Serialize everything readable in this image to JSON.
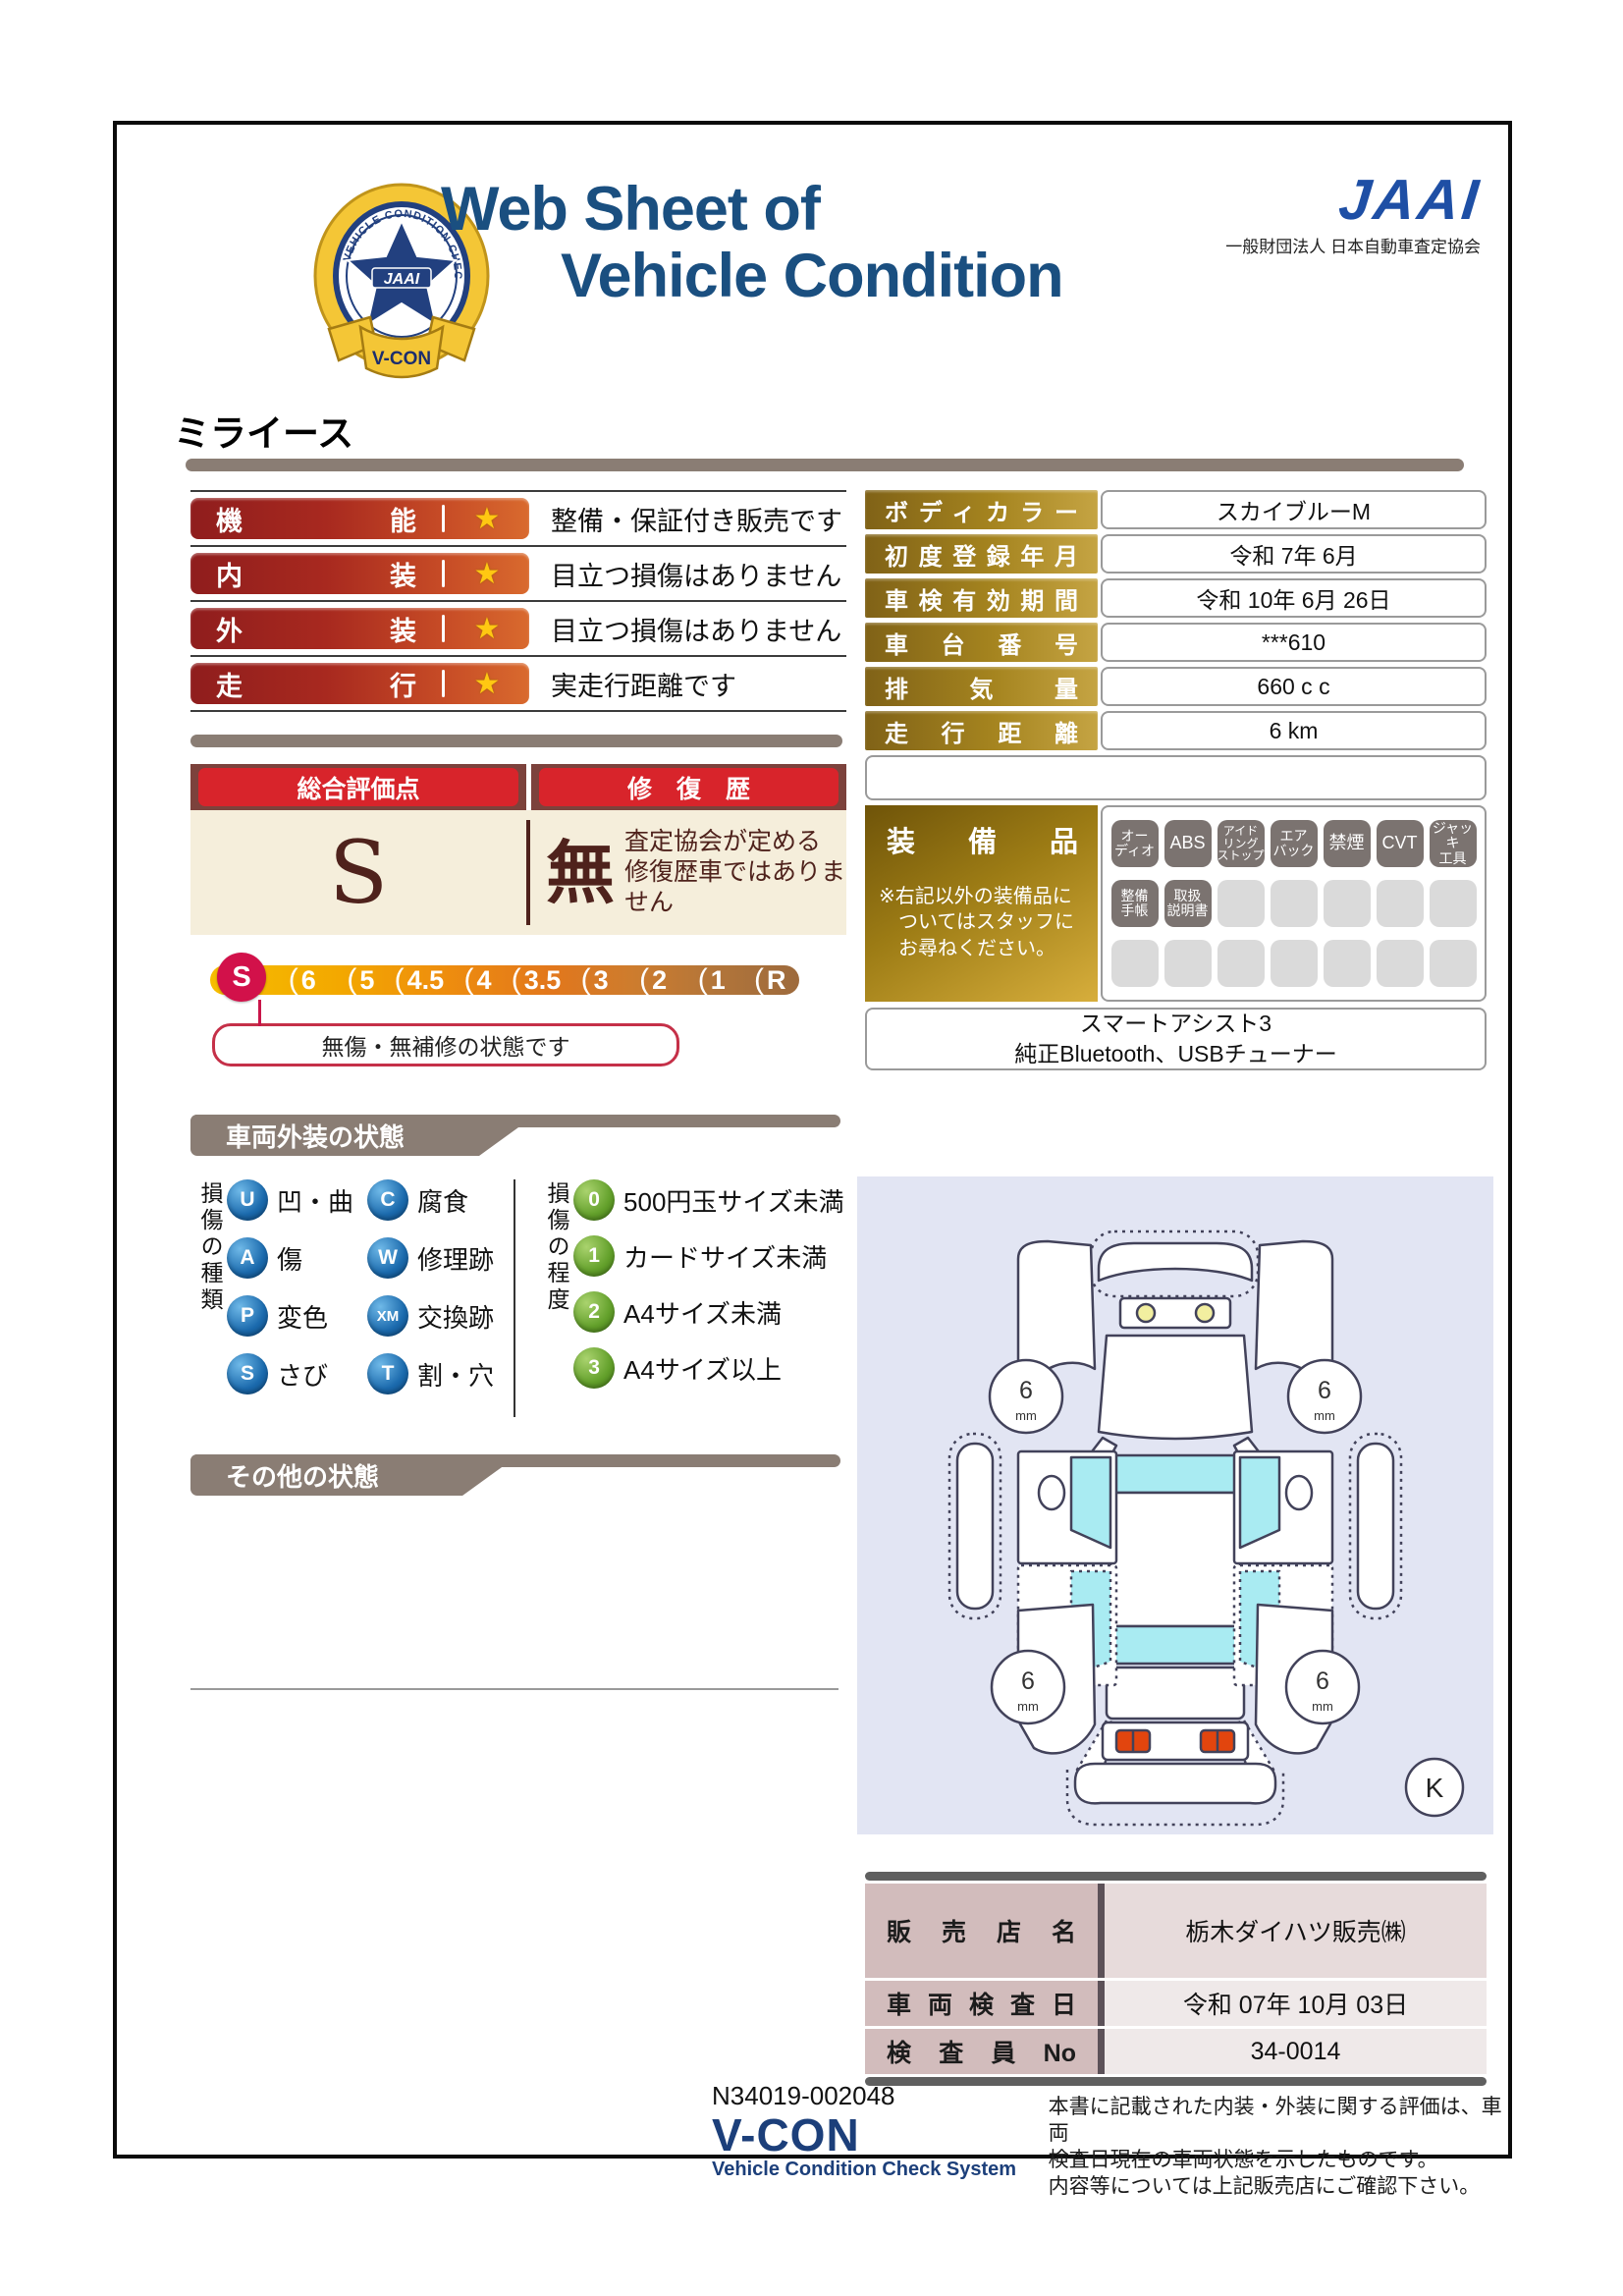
{
  "header": {
    "title_line1": "Web Sheet of",
    "title_line2": "Vehicle Condition",
    "jaai_mark": "JAAI",
    "jaai_subtitle": "一般財団法人 日本自動車査定協会",
    "emblem": {
      "ring_text": "VEHICLE CONDITION CHECK SYSTEM",
      "center": "JAAI",
      "ribbon": "V-CON"
    }
  },
  "vehicle_name": "ミライース",
  "ratings": [
    {
      "label": "機能",
      "star": "★",
      "desc": "整備・保証付き販売です"
    },
    {
      "label": "内装",
      "star": "★",
      "desc": "目立つ損傷はありません"
    },
    {
      "label": "外装",
      "star": "★",
      "desc": "目立つ損傷はありません"
    },
    {
      "label": "走行",
      "star": "★",
      "desc": "実走行距離です"
    }
  ],
  "overall": {
    "header_left": "総合評価点",
    "header_right": "修　復　歴",
    "score": "S",
    "repair": "無",
    "repair_note1": "査定協会が定める",
    "repair_note2": "修復歴車ではありません"
  },
  "scale": {
    "grades": [
      "S",
      "6",
      "5",
      "4.5",
      "4",
      "3.5",
      "3",
      "2",
      "1",
      "R"
    ],
    "active": "S",
    "callout": "無傷・無補修の状態です"
  },
  "vehicle_info": {
    "rows": [
      {
        "label": "ボディカラー",
        "value": "スカイブルーM"
      },
      {
        "label": "初度登録年月",
        "value": "令和 7年 6月"
      },
      {
        "label": "車検有効期間",
        "value": "令和 10年 6月 26日"
      },
      {
        "label": "車台番号",
        "value": "***610"
      },
      {
        "label": "排気量",
        "value": "660 c c"
      },
      {
        "label": "走行距離",
        "value": "6 km"
      }
    ]
  },
  "equipment": {
    "title": "装備品",
    "note1": "※右記以外の装備品に",
    "note2": "ついてはスタッフに",
    "note3": "お尋ねください。",
    "badges": [
      {
        "lines": [
          "オー",
          "ディオ"
        ]
      },
      {
        "lines": [
          "ABS"
        ]
      },
      {
        "lines": [
          "アイド",
          "リング",
          "ストップ"
        ]
      },
      {
        "lines": [
          "エア",
          "バック"
        ]
      },
      {
        "lines": [
          "禁煙"
        ]
      },
      {
        "lines": [
          "CVT"
        ]
      },
      {
        "lines": [
          "ジャッキ",
          "工具"
        ]
      },
      {
        "lines": [
          "整備",
          "手帳"
        ]
      },
      {
        "lines": [
          "取扱",
          "説明書"
        ]
      }
    ],
    "extra_line1": "スマートアシスト3",
    "extra_line2": "純正Bluetooth、USBチューナー"
  },
  "exterior_section": {
    "title": "車両外装の状態",
    "type_label": "損傷の種類",
    "types": [
      {
        "code": "U",
        "label": "凹・曲"
      },
      {
        "code": "C",
        "label": "腐食"
      },
      {
        "code": "A",
        "label": "傷"
      },
      {
        "code": "W",
        "label": "修理跡"
      },
      {
        "code": "P",
        "label": "変色"
      },
      {
        "code": "XM",
        "label": "交換跡"
      },
      {
        "code": "S",
        "label": "さび"
      },
      {
        "code": "T",
        "label": "割・穴"
      }
    ],
    "degree_label": "損傷の程度",
    "degrees": [
      {
        "code": "0",
        "label": "500円玉サイズ未満"
      },
      {
        "code": "1",
        "label": "カードサイズ未満"
      },
      {
        "code": "2",
        "label": "A4サイズ未満"
      },
      {
        "code": "3",
        "label": "A4サイズ以上"
      }
    ]
  },
  "other_section": {
    "title": "その他の状態"
  },
  "diagram": {
    "tires": [
      "6",
      "6",
      "6",
      "6"
    ],
    "tire_unit": "mm",
    "marker": "K"
  },
  "dealer": {
    "rows": [
      {
        "label": "販売店名",
        "value": "栃木ダイハツ販売㈱"
      },
      {
        "label": "車両検査日",
        "value": "令和 07年 10月 03日"
      },
      {
        "label": "検査員No",
        "value": "34-0014"
      }
    ]
  },
  "footer": {
    "doc_no": "N34019-002048",
    "vcon": "V-CON",
    "vcon_sub": "Vehicle Condition Check System",
    "disclaimer1": "本書に記載された内装・外装に関する評価は、車両",
    "disclaimer2": "検査日現在の車両状態を示したものです。",
    "disclaimer3": "内容等については上記販売店にご確認下さい。"
  },
  "colors": {
    "title_blue": "#1a4f80",
    "jaai_blue": "#1e4fa5",
    "badge_red_dark": "#8f1d1d",
    "badge_orange": "#d96a2e",
    "gold_dark": "#806217",
    "gold_light": "#c5a443",
    "maroon": "#7c423c",
    "highlight_red": "#d8242b",
    "cream": "#f5eedb",
    "crimson": "#d2114a",
    "taupe": "#8a7d74",
    "footer_blue": "#1c3f7a",
    "diagram_bg": "#e2e5f3",
    "window_cyan": "#a9ebf2"
  }
}
